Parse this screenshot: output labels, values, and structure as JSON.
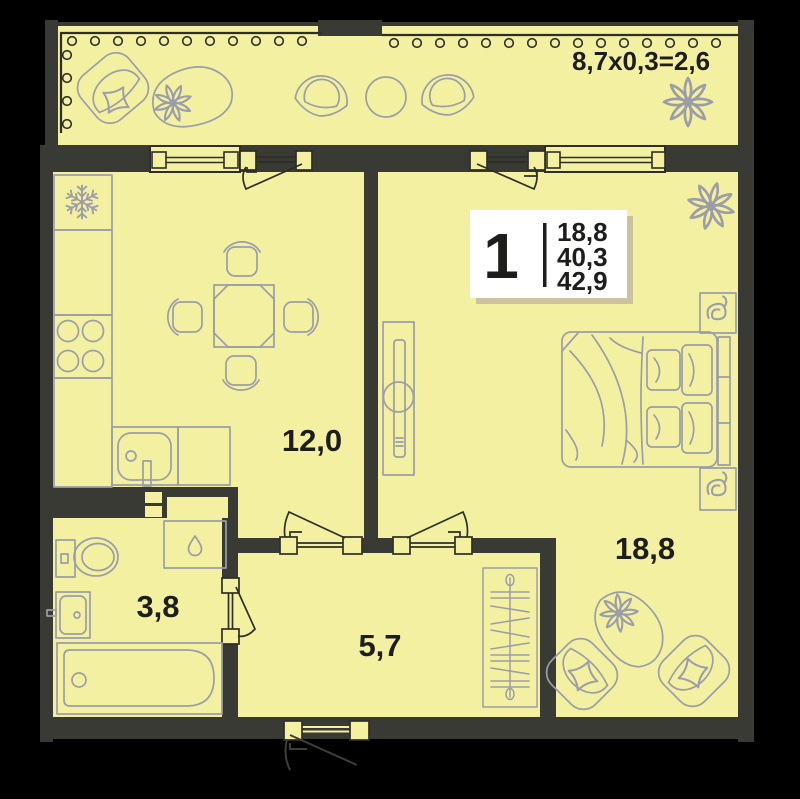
{
  "floor_plan": {
    "balcony": {
      "dimension_label": "8,7x0,3=2,6"
    },
    "unit_card": {
      "room_count": "1",
      "living_area": "18,8",
      "area_without_balcony": "40,3",
      "total_area": "42,9"
    },
    "rooms": {
      "kitchen_living": {
        "area": "12,0"
      },
      "bedroom": {
        "area": "18,8"
      },
      "bathroom": {
        "area": "3,8"
      },
      "hallway": {
        "area": "5,7"
      }
    },
    "colors": {
      "background": "#000000",
      "floor": "#F4F0A2",
      "walls": "#3A3A34",
      "furniture_outline": "#9B9DA8",
      "fixture_dark_line": "#2E2E29",
      "label_text": "#1D1D1B",
      "card_background": "#FFFFFF",
      "card_shadow": "#CBC39B"
    }
  }
}
